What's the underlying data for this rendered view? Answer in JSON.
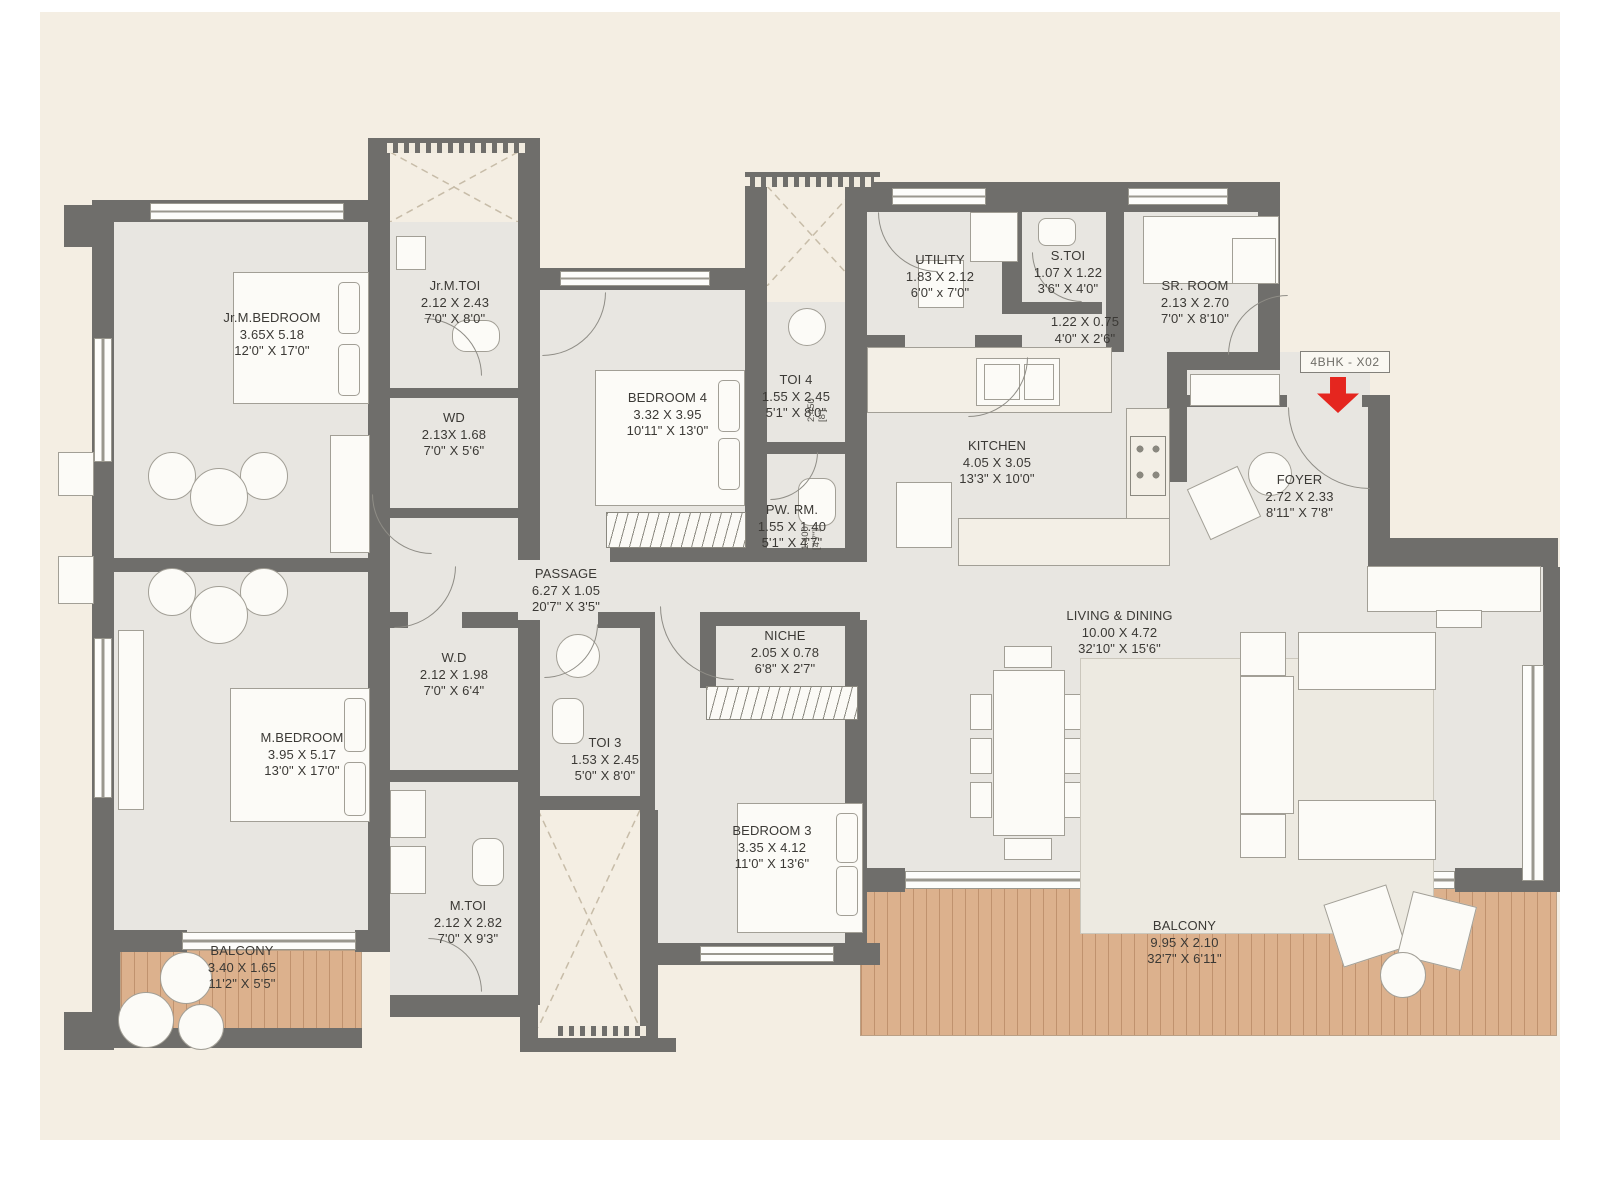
{
  "plan_title": "4BHK floor plan",
  "unit": {
    "label": "4BHK - X02"
  },
  "colors": {
    "wall": "#6f6e6b",
    "floor": "#e8e6e1",
    "background": "#f4eee3",
    "balcony_wood": "#dcb18d",
    "arrow_red": "#e5261f"
  },
  "rooms": {
    "jr_m_bedroom": {
      "name": "Jr.M.BEDROOM",
      "m": "3.65X 5.18",
      "ft": "12'0\" X 17'0\""
    },
    "jr_m_toi": {
      "name": "Jr.M.TOI",
      "m": "2.12 X 2.43",
      "ft": "7'0\" X 8'0\""
    },
    "wd_top": {
      "name": "WD",
      "m": "2.13X 1.68",
      "ft": "7'0\" X 5'6\""
    },
    "bedroom4": {
      "name": "BEDROOM 4",
      "m": "3.32 X 3.95",
      "ft": "10'11\" X 13'0\""
    },
    "toi4": {
      "name": "TOI 4",
      "m": "1.55 X 2.45",
      "ft": "5'1\" X 8'0\""
    },
    "pw_rm": {
      "name": "PW. RM.",
      "m": "1.55 X 1.40",
      "ft": "5'1\" X 4'7\""
    },
    "utility": {
      "name": "UTILITY",
      "m": "1.83 X 2.12",
      "ft": "6'0\" x 7'0\""
    },
    "s_toi": {
      "name": "S.TOI",
      "m": "1.07 X 1.22",
      "ft": "3'6\" X 4'0\""
    },
    "sr_room": {
      "name": "SR. ROOM",
      "m": "2.13 X 2.70",
      "ft": "7'0\" X 8'10\""
    },
    "lobby": {
      "m": "1.22 X 0.75",
      "ft": "4'0\" X 2'6\""
    },
    "kitchen": {
      "name": "KITCHEN",
      "m": "4.05 X 3.05",
      "ft": "13'3\" X 10'0\""
    },
    "foyer": {
      "name": "FOYER",
      "m": "2.72 X 2.33",
      "ft": "8'11\" X 7'8\""
    },
    "passage": {
      "name": "PASSAGE",
      "m": "6.27 X 1.05",
      "ft": "20'7\" X 3'5\""
    },
    "living_dining": {
      "name": "LIVING & DINING",
      "m": "10.00 X 4.72",
      "ft": "32'10\" X 15'6\""
    },
    "m_bedroom": {
      "name": "M.BEDROOM",
      "m": "3.95 X 5.17",
      "ft": "13'0\" X 17'0\""
    },
    "wd_mid": {
      "name": "W.D",
      "m": "2.12 X 1.98",
      "ft": "7'0\" X 6'4\""
    },
    "toi3": {
      "name": "TOI 3",
      "m": "1.53 X 2.45",
      "ft": "5'0\" X 8'0\""
    },
    "niche": {
      "name": "NICHE",
      "m": "2.05 X 0.78",
      "ft": "6'8\" X 2'7\""
    },
    "bedroom3": {
      "name": "BEDROOM 3",
      "m": "3.35 X 4.12",
      "ft": "11'0\" X 13'6\""
    },
    "m_toi": {
      "name": "M.TOI",
      "m": "2.12 X 2.82",
      "ft": "7'0\" X 9'3\""
    },
    "balcony_left": {
      "name": "BALCONY",
      "m": "3.40 X 1.65",
      "ft": "11'2\" X 5'5\""
    },
    "balcony_right": {
      "name": "BALCONY",
      "m": "9.95 X 2.10",
      "ft": "32'7\" X 6'11\""
    }
  },
  "annotations": {
    "toi4_shaft_a": "2.450",
    "toi4_shaft_b": "[8']",
    "pw_shaft_a": "1.400",
    "pw_shaft_b": "[4'7\"]"
  }
}
